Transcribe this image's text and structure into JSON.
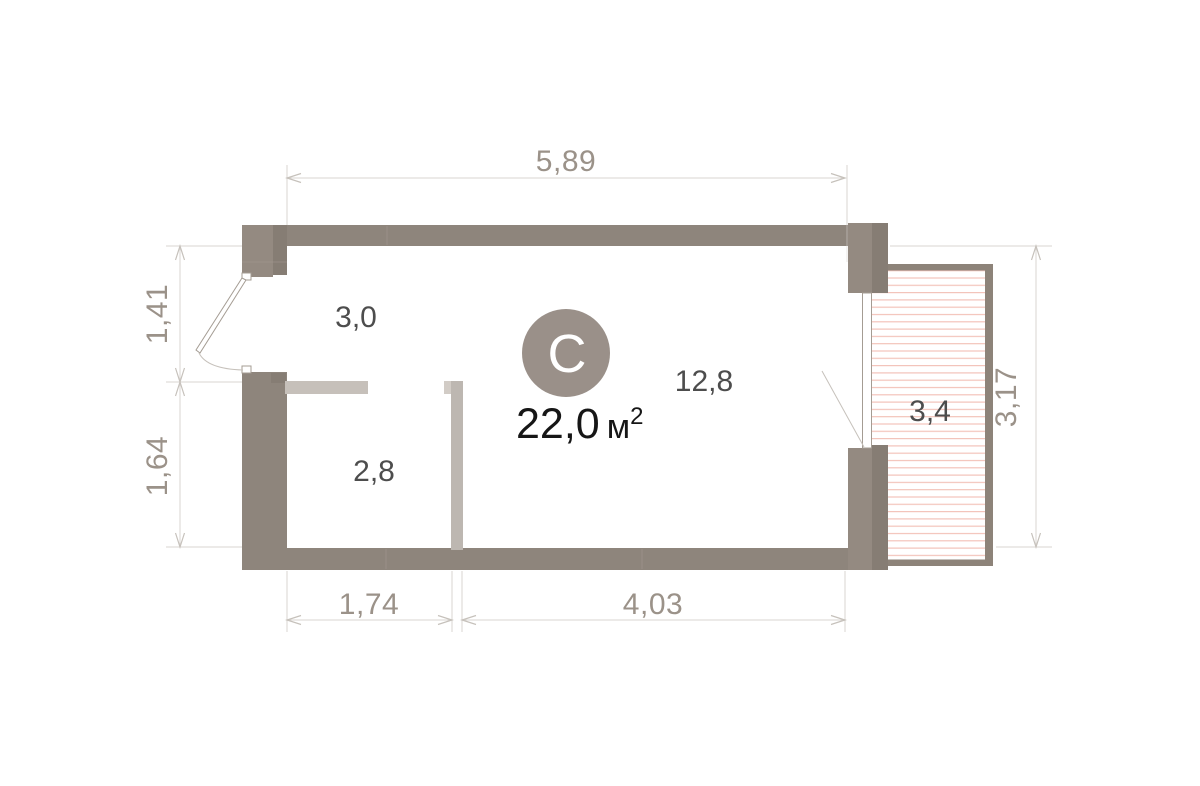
{
  "plan": {
    "unit_badge_letter": "C",
    "total_area": {
      "value": "22,0",
      "unit": "м",
      "sup": "2"
    },
    "rooms": [
      {
        "id": "hall",
        "area_label": "3,0"
      },
      {
        "id": "bathroom",
        "area_label": "2,8"
      },
      {
        "id": "living-room",
        "area_label": "12,8"
      },
      {
        "id": "balcony",
        "area_label": "3,4"
      }
    ],
    "dimensions": {
      "top": "5,89",
      "left_upper": "1,41",
      "left_lower": "1,64",
      "right": "3,17",
      "bottom_left": "1,74",
      "bottom_right": "4,03"
    }
  },
  "colors": {
    "bg": "#ffffff",
    "wall": "#8e857c",
    "wall_light": "#948a81",
    "wall_dark": "#867d74",
    "partition": "#c6c0ba",
    "partition_light": "#d2ccc6",
    "partition_dark": "#bdb7b1",
    "balcony_border": "#8d8379",
    "hatch": "#f3c3ba",
    "dim_line": "#d8d4d0",
    "dim_arrow": "#c6c1bb",
    "dim_text": "#9b9289",
    "room_text": "#4d4d4d",
    "area_text": "#161616",
    "badge": "#9a9089",
    "badge_text": "#ffffff",
    "seam": "#a39a91",
    "door": "#a49c93"
  }
}
